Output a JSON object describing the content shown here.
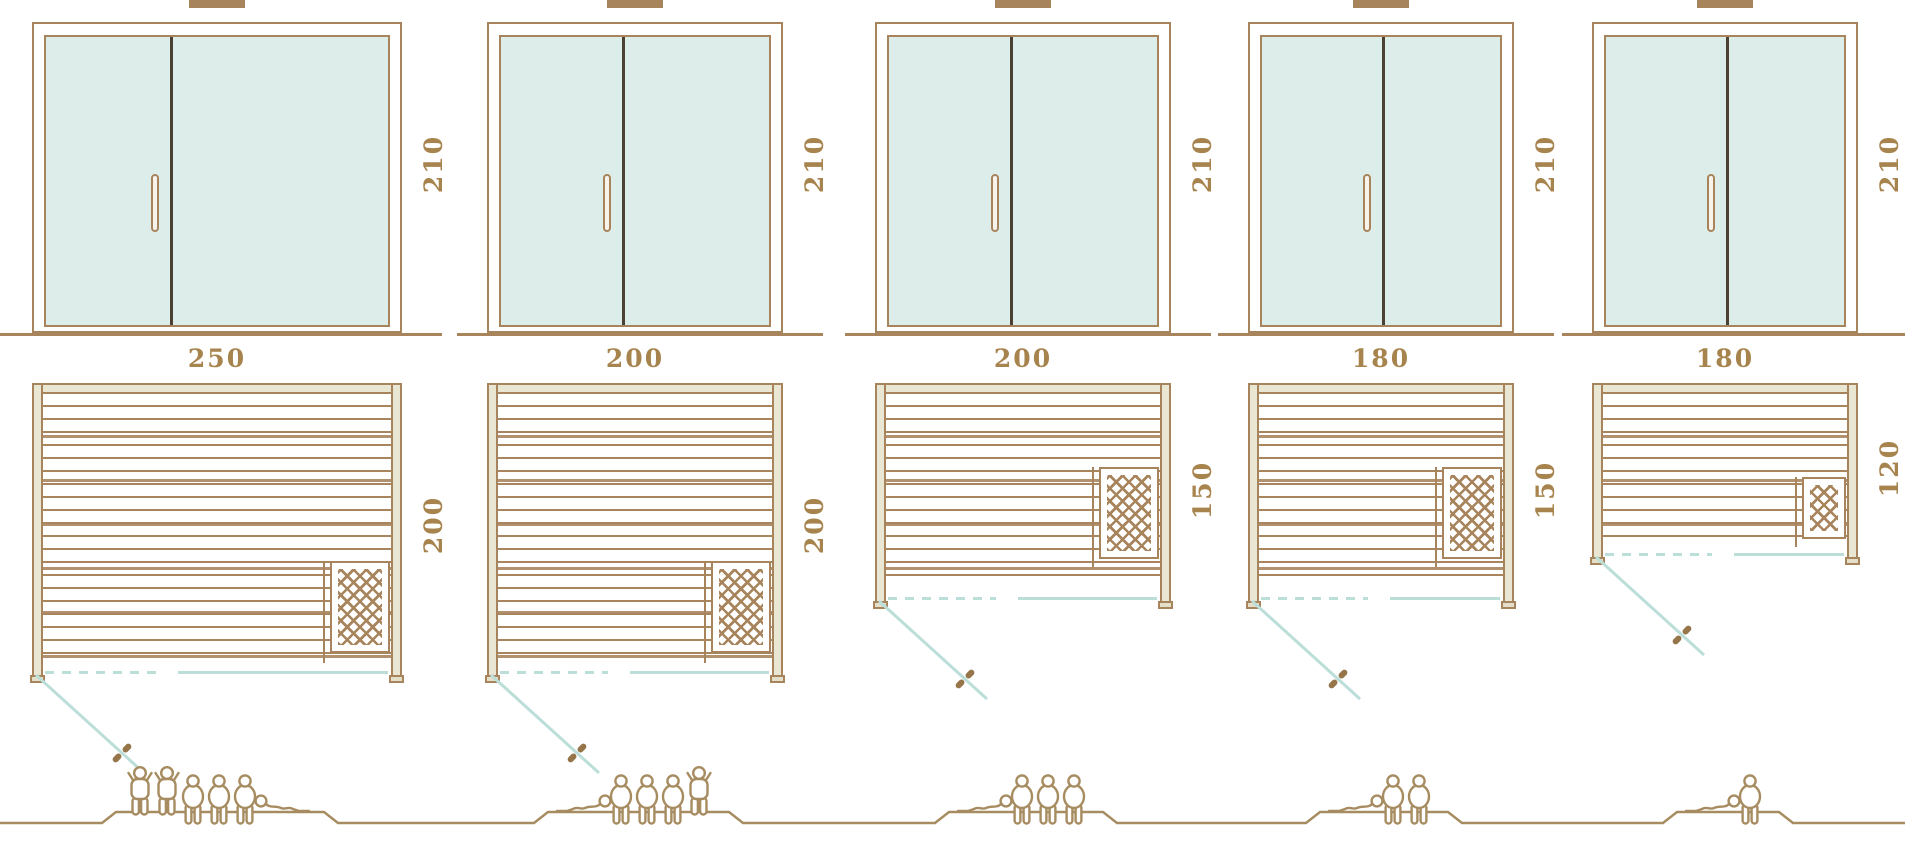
{
  "diagram_title": "",
  "colors": {
    "frame_brown": "#a8845c",
    "dimension_text": "#a7844e",
    "glass_fill": "#ddeeea",
    "teal_line": "#bcded9",
    "beige_wood": "#e9e6d3",
    "door_divider_dark": "#4a4034",
    "people_outline": "#a68c60"
  },
  "columns": [
    {
      "width_label": "250",
      "height_label": "210",
      "depth_label": "200",
      "width_cm": 250,
      "height_cm": 210,
      "depth_cm": 200,
      "capacity": 6,
      "people": [
        "standing",
        "standing",
        "sitting",
        "sitting",
        "sitting",
        "lying"
      ]
    },
    {
      "width_label": "200",
      "height_label": "210",
      "depth_label": "200",
      "width_cm": 200,
      "height_cm": 210,
      "depth_cm": 200,
      "capacity": 5,
      "people": [
        "lying",
        "sitting",
        "sitting",
        "sitting",
        "standing"
      ]
    },
    {
      "width_label": "200",
      "height_label": "210",
      "depth_label": "150",
      "width_cm": 200,
      "height_cm": 210,
      "depth_cm": 150,
      "capacity": 4,
      "people": [
        "lying",
        "sitting",
        "sitting",
        "sitting"
      ]
    },
    {
      "width_label": "180",
      "height_label": "210",
      "depth_label": "150",
      "width_cm": 180,
      "height_cm": 210,
      "depth_cm": 150,
      "capacity": 3,
      "people": [
        "lying",
        "sitting",
        "sitting"
      ]
    },
    {
      "width_label": "180",
      "height_label": "210",
      "depth_label": "120",
      "width_cm": 180,
      "height_cm": 210,
      "depth_cm": 120,
      "capacity": 2,
      "people": [
        "lying",
        "sitting"
      ]
    }
  ]
}
